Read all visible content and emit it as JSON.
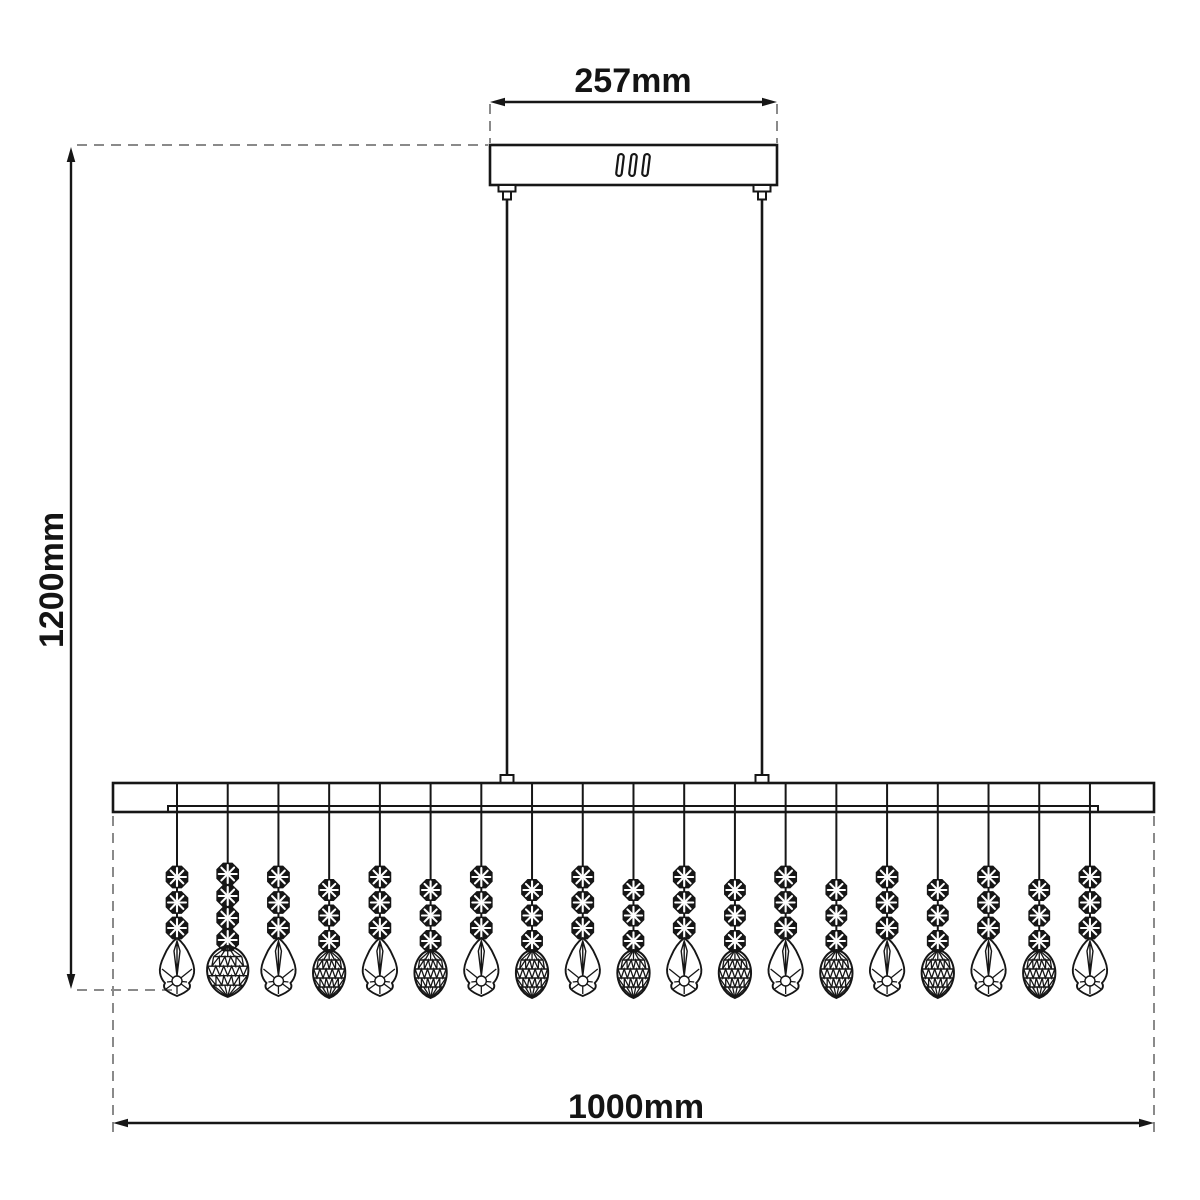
{
  "drawing": {
    "type": "technical-dimension-diagram",
    "subject": "linear-bar-pendant-light-with-crystal-drops",
    "labels": {
      "canopy_width": "257mm",
      "overall_height": "1200mm",
      "bar_width": "1000mm"
    },
    "colors": {
      "line": "#161616",
      "dashed": "#8a8a8a",
      "background": "#ffffff"
    },
    "geometry": {
      "canopy": {
        "x": 490,
        "y": 145,
        "width": 287,
        "height": 40
      },
      "canopy_slots": {
        "centers_x": [
          620,
          633,
          646
        ],
        "center_y": 165,
        "width": 5.5,
        "height": 22,
        "tilt_deg": 7
      },
      "rods": {
        "xs": [
          507,
          762
        ],
        "top_y": 199,
        "bottom_y": 775
      },
      "bar": {
        "x": 113,
        "y": 783,
        "width": 1041,
        "height": 29,
        "lip_y": 806,
        "lip_x1": 168,
        "lip_x2": 1098
      },
      "strands": {
        "start_x": 177,
        "spacing": 50.72,
        "wire_top_y": 784,
        "types": [
          "open",
          "faceted-large",
          "open",
          "faceted",
          "open",
          "faceted",
          "open",
          "faceted",
          "open",
          "faceted",
          "open",
          "faceted",
          "open",
          "faceted",
          "open",
          "faceted",
          "open",
          "faceted",
          "open"
        ],
        "bead_counts": {
          "open": 3,
          "faceted": 3,
          "faceted-large": 4
        }
      },
      "dim_top": {
        "y": 102,
        "x1": 490,
        "x2": 777,
        "ext_y1": 104,
        "ext_y2": 143
      },
      "dim_left": {
        "x": 71,
        "y1": 147,
        "y2": 989,
        "ext_top": {
          "y": 145,
          "x1": 77,
          "x2": 488
        },
        "ext_bottom": {
          "y": 990,
          "x1": 77,
          "x2": 175
        }
      },
      "dim_bottom": {
        "y": 1123,
        "x1": 113,
        "x2": 1154,
        "ext_y1": 816,
        "ext_y2": 1134
      }
    }
  }
}
